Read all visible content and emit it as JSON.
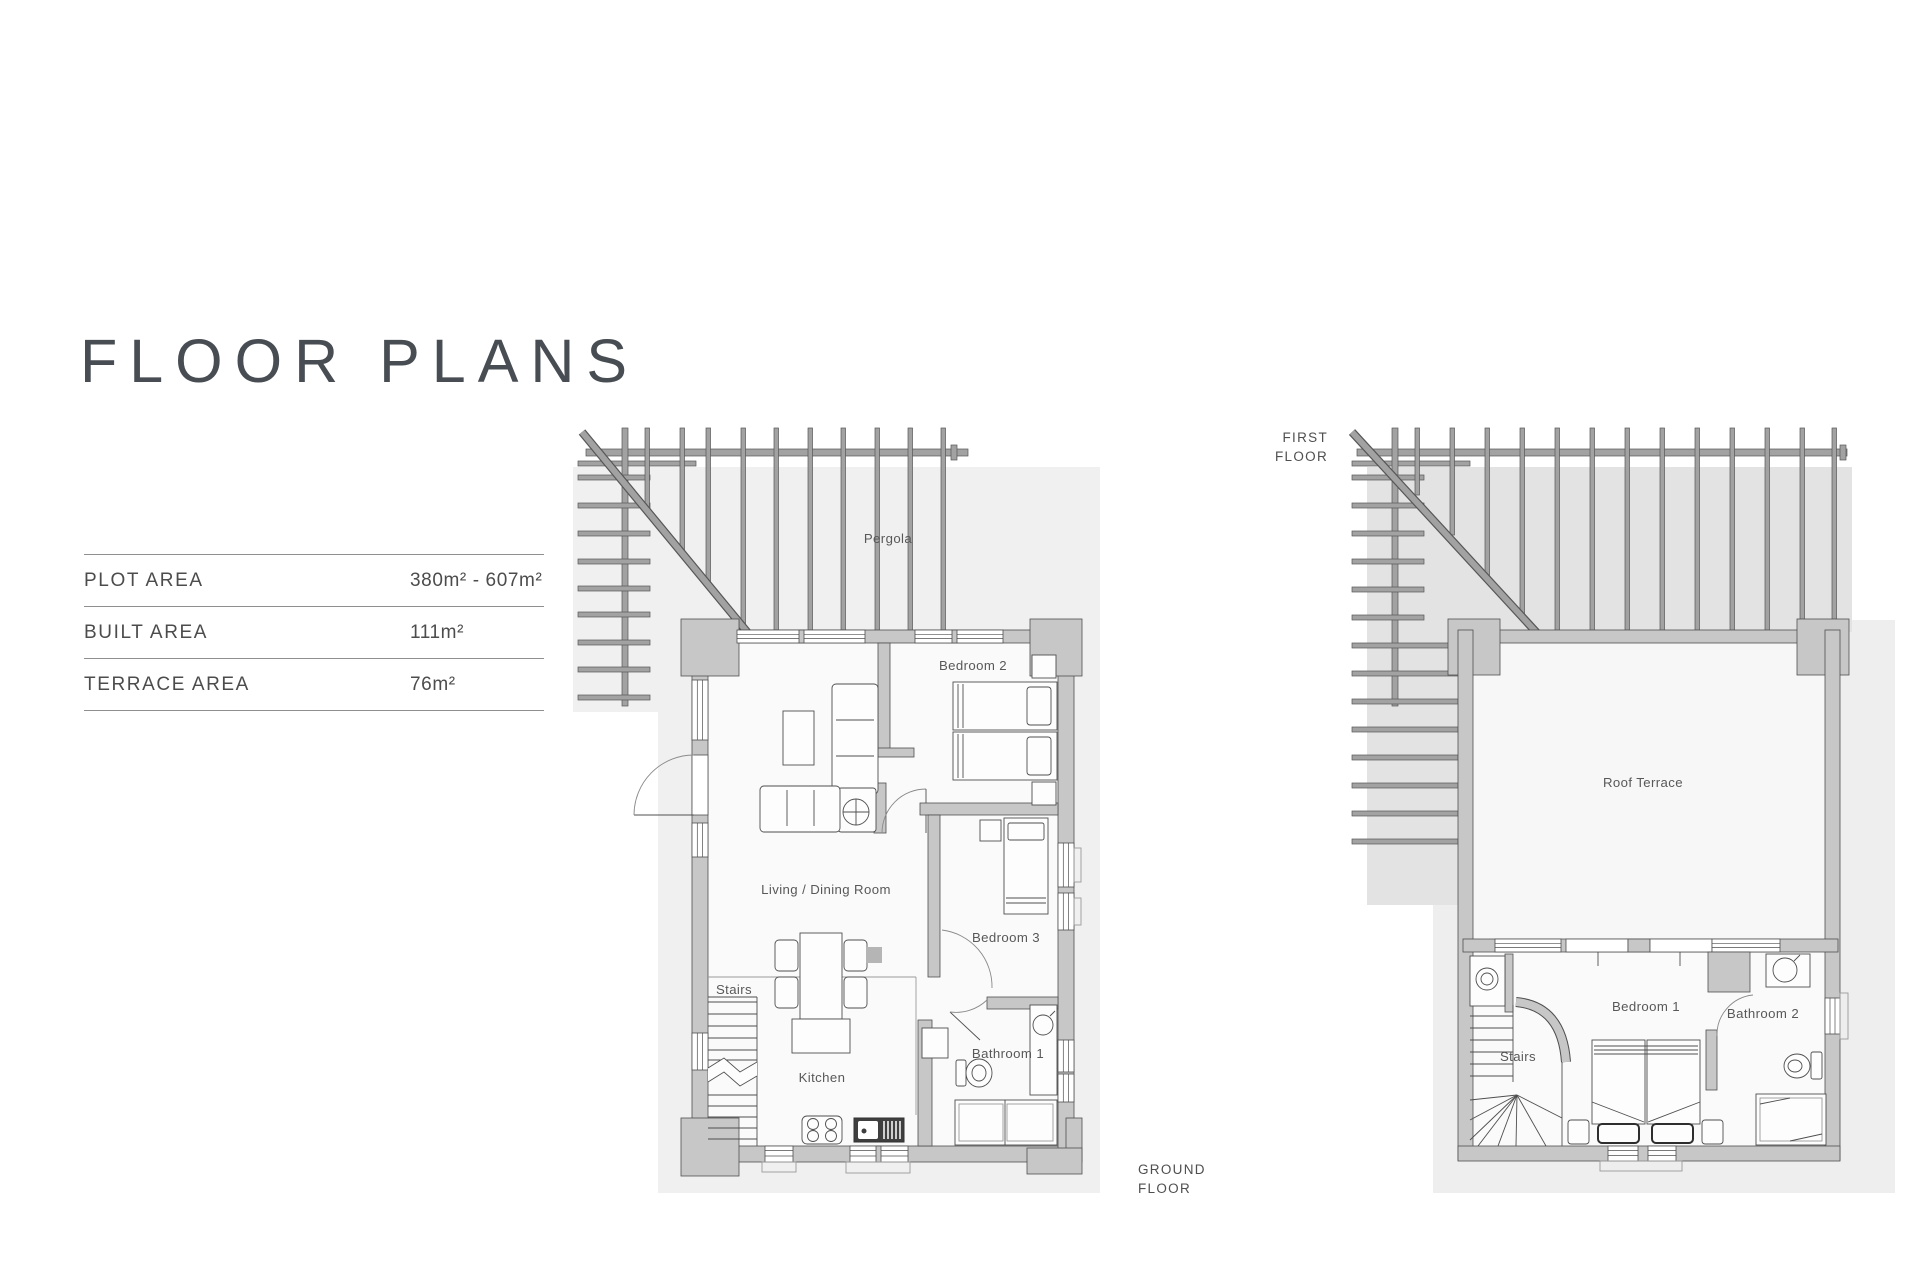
{
  "page": {
    "title": "FLOOR PLANS"
  },
  "area_table": {
    "rows": [
      {
        "label": "PLOT AREA",
        "value": "380m² - 607m²"
      },
      {
        "label": "BUILT AREA",
        "value": "111m²"
      },
      {
        "label": "TERRACE AREA",
        "value": "76m²"
      }
    ]
  },
  "ground_floor": {
    "caption_line1": "GROUND",
    "caption_line2": "FLOOR",
    "labels": {
      "pergola": "Pergola",
      "bedroom2": "Bedroom 2",
      "living_dining": "Living / Dining Room",
      "bedroom3": "Bedroom 3",
      "stairs": "Stairs",
      "kitchen": "Kitchen",
      "bathroom1": "Bathroom 1"
    }
  },
  "first_floor": {
    "caption_line1": "FIRST",
    "caption_line2": "FLOOR",
    "labels": {
      "roof_terrace": "Roof Terrace",
      "bedroom1": "Bedroom 1",
      "bathroom2": "Bathroom 2",
      "stairs": "Stairs"
    }
  },
  "colors": {
    "wall": "#c7c7c7",
    "outline": "#4f4f4f",
    "pergola_bar": "#a2a2a2",
    "backdrop": "#f0f0f0",
    "backdrop_dark": "#e3e3e3",
    "label_text": "#585858",
    "title_text": "#474d52"
  }
}
